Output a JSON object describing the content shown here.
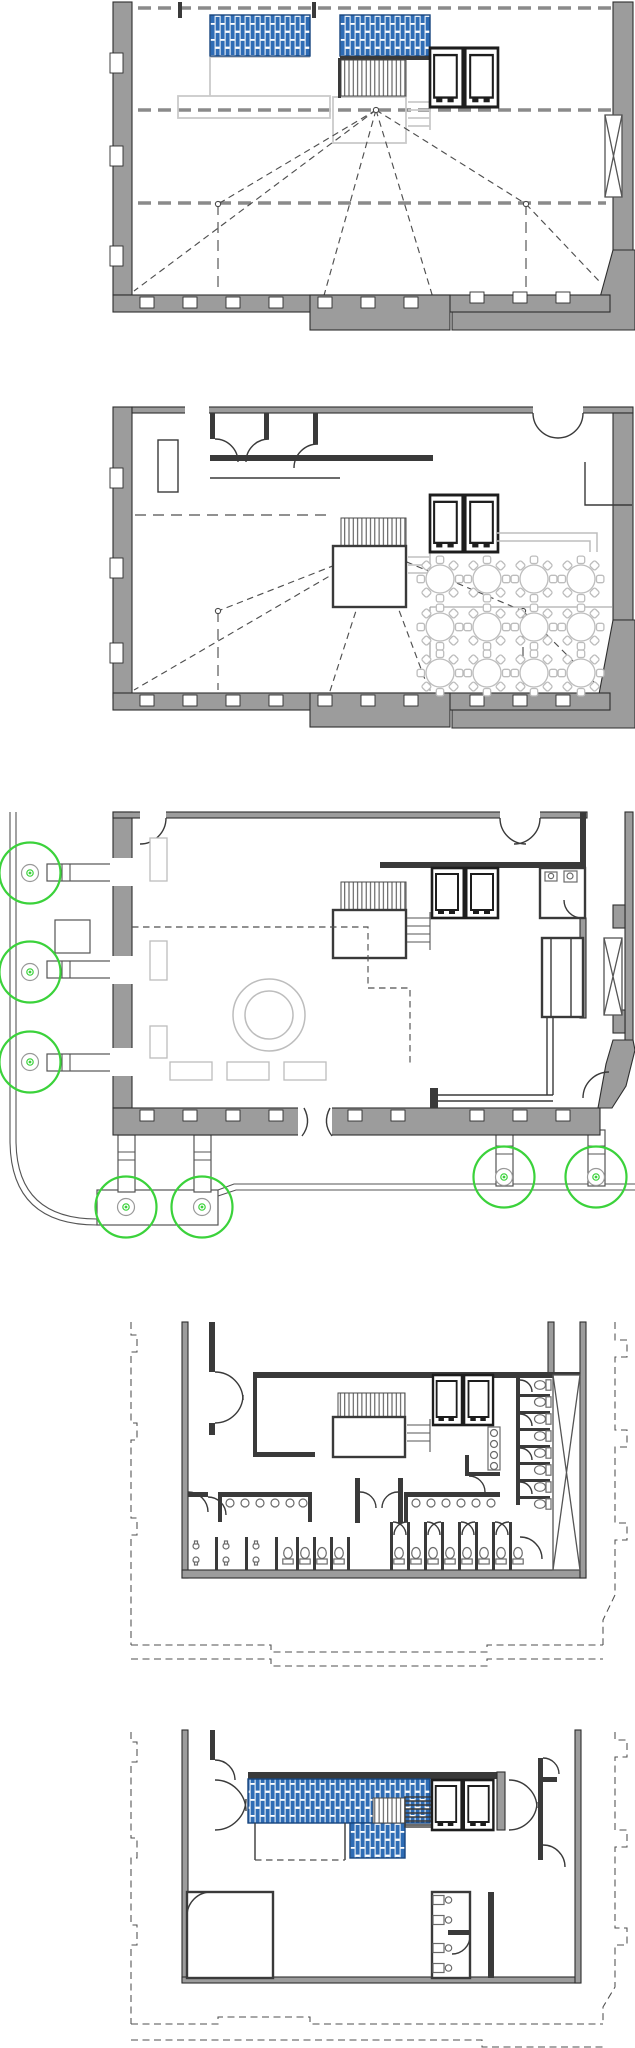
{
  "colors": {
    "paper": "#ffffff",
    "wall_fill": "#9c9c9c",
    "wall_stroke": "#2e2e2e",
    "partition": "#3a3a3a",
    "ghost": "#cacaca",
    "furniture": "#bdbdbd",
    "glass_blue": "#2e6cb5",
    "glass_frame": "#17457e",
    "dash_heavy": "#8a8a8a",
    "dash_thin": "#4f4f4f",
    "green": "#3bd23b",
    "sidewalk": "#555555"
  },
  "figure": {
    "type": "architectural-floor-plan-set",
    "plan_count": 5,
    "plans": [
      {
        "name": "top-floor-plan",
        "skylight_panels": 2,
        "elevator_cars": 2,
        "heavy_dashed_lines": 3,
        "sightline_hubs": 3
      },
      {
        "name": "mezzanine-banquet-plan",
        "banquet_tables": 12,
        "chairs_per_table": 8,
        "elevator_cars": 2
      },
      {
        "name": "ground-floor-plan",
        "street_trees": 7,
        "elevator_cars": 2,
        "porch_columns": 7
      },
      {
        "name": "basement-washroom-plan",
        "elevator_cars": 2,
        "wc_stalls_right_column": 8,
        "sink_counters": 3
      },
      {
        "name": "sub-basement-plan",
        "elevator_cars": 2,
        "glazed_area_panels": 2,
        "wc_fixtures": 4
      }
    ]
  }
}
